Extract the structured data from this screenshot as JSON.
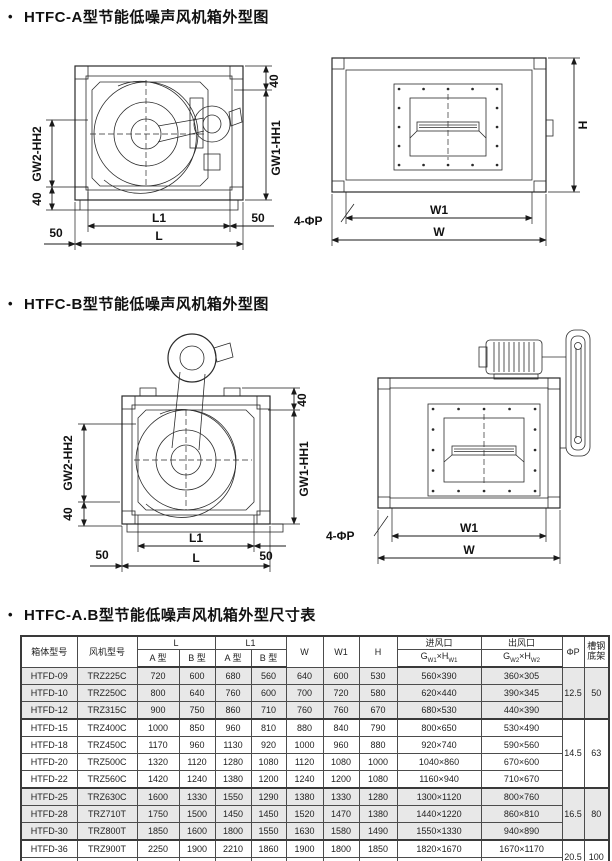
{
  "page": {
    "bullet": "•"
  },
  "titles": {
    "a": "HTFC-A型节能低噪声风机箱外型图",
    "b": "HTFC-B型节能低噪声风机箱外型图",
    "table": "HTFC-A.B型节能低噪声风机箱外型尺寸表"
  },
  "dims": {
    "d40": "40",
    "d50": "50",
    "gw1hh1": "GW1-HH1",
    "gw2hh2": "GW2-HH2",
    "L1": "L1",
    "L": "L",
    "W1": "W1",
    "W": "W",
    "H": "H",
    "phiP": "4-ΦP"
  },
  "table": {
    "headers": {
      "box": "箱体型号",
      "fan": "风机型号",
      "L": "L",
      "L1": "L1",
      "typeA": "A 型",
      "typeB": "B 型",
      "W": "W",
      "W1": "W1",
      "H": "H",
      "inlet": "进风口",
      "outlet": "出风口",
      "g": "G",
      "xh": "×H",
      "w1s": "W1",
      "w2s": "W2",
      "phiP": "ΦP",
      "channel": "槽钢\n底架"
    },
    "rows": [
      [
        "HTFD-09",
        "TRZ225C",
        "720",
        "600",
        "680",
        "560",
        "640",
        "600",
        "530",
        "560×390",
        "360×305"
      ],
      [
        "HTFD-10",
        "TRZ250C",
        "800",
        "640",
        "760",
        "600",
        "700",
        "720",
        "580",
        "620×440",
        "390×345"
      ],
      [
        "HTFD-12",
        "TRZ315C",
        "900",
        "750",
        "860",
        "710",
        "760",
        "760",
        "670",
        "680×530",
        "440×390"
      ],
      [
        "HTFD-15",
        "TRZ400C",
        "1000",
        "850",
        "960",
        "810",
        "880",
        "840",
        "790",
        "800×650",
        "530×490"
      ],
      [
        "HTFD-18",
        "TRZ450C",
        "1170",
        "960",
        "1130",
        "920",
        "1000",
        "960",
        "880",
        "920×740",
        "590×560"
      ],
      [
        "HTFD-20",
        "TRZ500C",
        "1320",
        "1120",
        "1280",
        "1080",
        "1120",
        "1080",
        "1000",
        "1040×860",
        "670×600"
      ],
      [
        "HTFD-22",
        "TRZ560C",
        "1420",
        "1240",
        "1380",
        "1200",
        "1240",
        "1200",
        "1080",
        "1160×940",
        "710×670"
      ],
      [
        "HTFD-25",
        "TRZ630C",
        "1600",
        "1330",
        "1550",
        "1290",
        "1380",
        "1330",
        "1280",
        "1300×1120",
        "800×760"
      ],
      [
        "HTFD-28",
        "TRZ710T",
        "1750",
        "1500",
        "1450",
        "1450",
        "1520",
        "1470",
        "1380",
        "1440×1220",
        "860×810"
      ],
      [
        "HTFD-30",
        "TRZ800T",
        "1850",
        "1600",
        "1800",
        "1550",
        "1630",
        "1580",
        "1490",
        "1550×1330",
        "940×890"
      ],
      [
        "HTFD-36",
        "TRZ900T",
        "2250",
        "1900",
        "2210",
        "1860",
        "1900",
        "1800",
        "1850",
        "1820×1670",
        "1670×1170"
      ],
      [
        "HTFD-40",
        "TRZ1000T",
        "2450",
        "2000",
        "2410",
        "1960",
        "2000",
        "1900",
        "2010",
        "1920×1830",
        "1830×1310"
      ]
    ],
    "groups": [
      {
        "phi": "12.5",
        "base": "50"
      },
      {
        "phi": "14.5",
        "base": "63"
      },
      {
        "phi": "16.5",
        "base": "80"
      },
      {
        "phi": "20.5",
        "base": "100"
      }
    ]
  }
}
